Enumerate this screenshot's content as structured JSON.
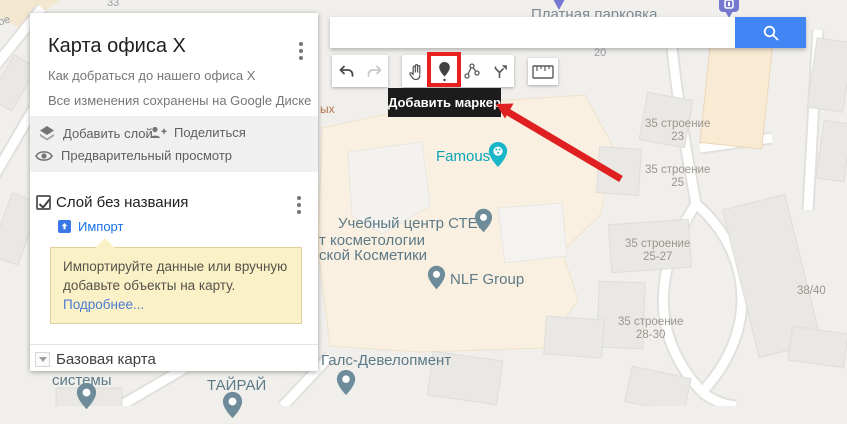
{
  "panel": {
    "title": "Карта офиса X",
    "subtitle": "Как добраться до нашего офиса X",
    "saved_status": "Все изменения сохранены на Google Диске",
    "actions": {
      "add_layer": "Добавить слой",
      "share": "Поделиться",
      "preview": "Предварительный просмотр"
    },
    "layer": {
      "name": "Слой без названия",
      "import_label": "Импорт"
    },
    "hint": {
      "text": "Импортируйте данные или вручную добавьте объекты на карту. ",
      "link": "Подробнее..."
    },
    "base_map_label": "Базовая карта"
  },
  "toolbar": {
    "tooltip": "Добавить маркер",
    "buttons": [
      "undo",
      "redo",
      "pan",
      "add-marker",
      "draw-line",
      "add-directions",
      "measure"
    ]
  },
  "search": {
    "value": "",
    "placeholder": ""
  },
  "map": {
    "labels": [
      {
        "text": "Famous"
      },
      {
        "text": "Учебный центр СТЕК"
      },
      {
        "text": "т косметологии"
      },
      {
        "text": "ской Косметики"
      },
      {
        "text": "NLF Group"
      },
      {
        "text": "Галс-Девелопмент"
      },
      {
        "text": "ТАЙРАЙ"
      },
      {
        "text": "системы"
      },
      {
        "text": "Платная парковка"
      },
      {
        "line1": "35 строение",
        "line2": "23"
      },
      {
        "line1": "35 строение",
        "line2": "25"
      },
      {
        "line1": "35 строение",
        "line2": "25-27"
      },
      {
        "line1": "35 строение",
        "line2": "28-30"
      },
      {
        "text": "38/40"
      },
      {
        "text": "20"
      },
      {
        "text": "33"
      },
      {
        "text": "ых"
      },
      {
        "text": "ое"
      }
    ]
  },
  "colors": {
    "accent_blue": "#4285f4",
    "annotation_red": "#e8201e",
    "poi_teal": "#14b5c8",
    "poi_gray": "#6e8b99",
    "parking_purple": "#7678cf",
    "hint_yellow": "#fbf1c7",
    "link_blue": "#1a73e8"
  }
}
